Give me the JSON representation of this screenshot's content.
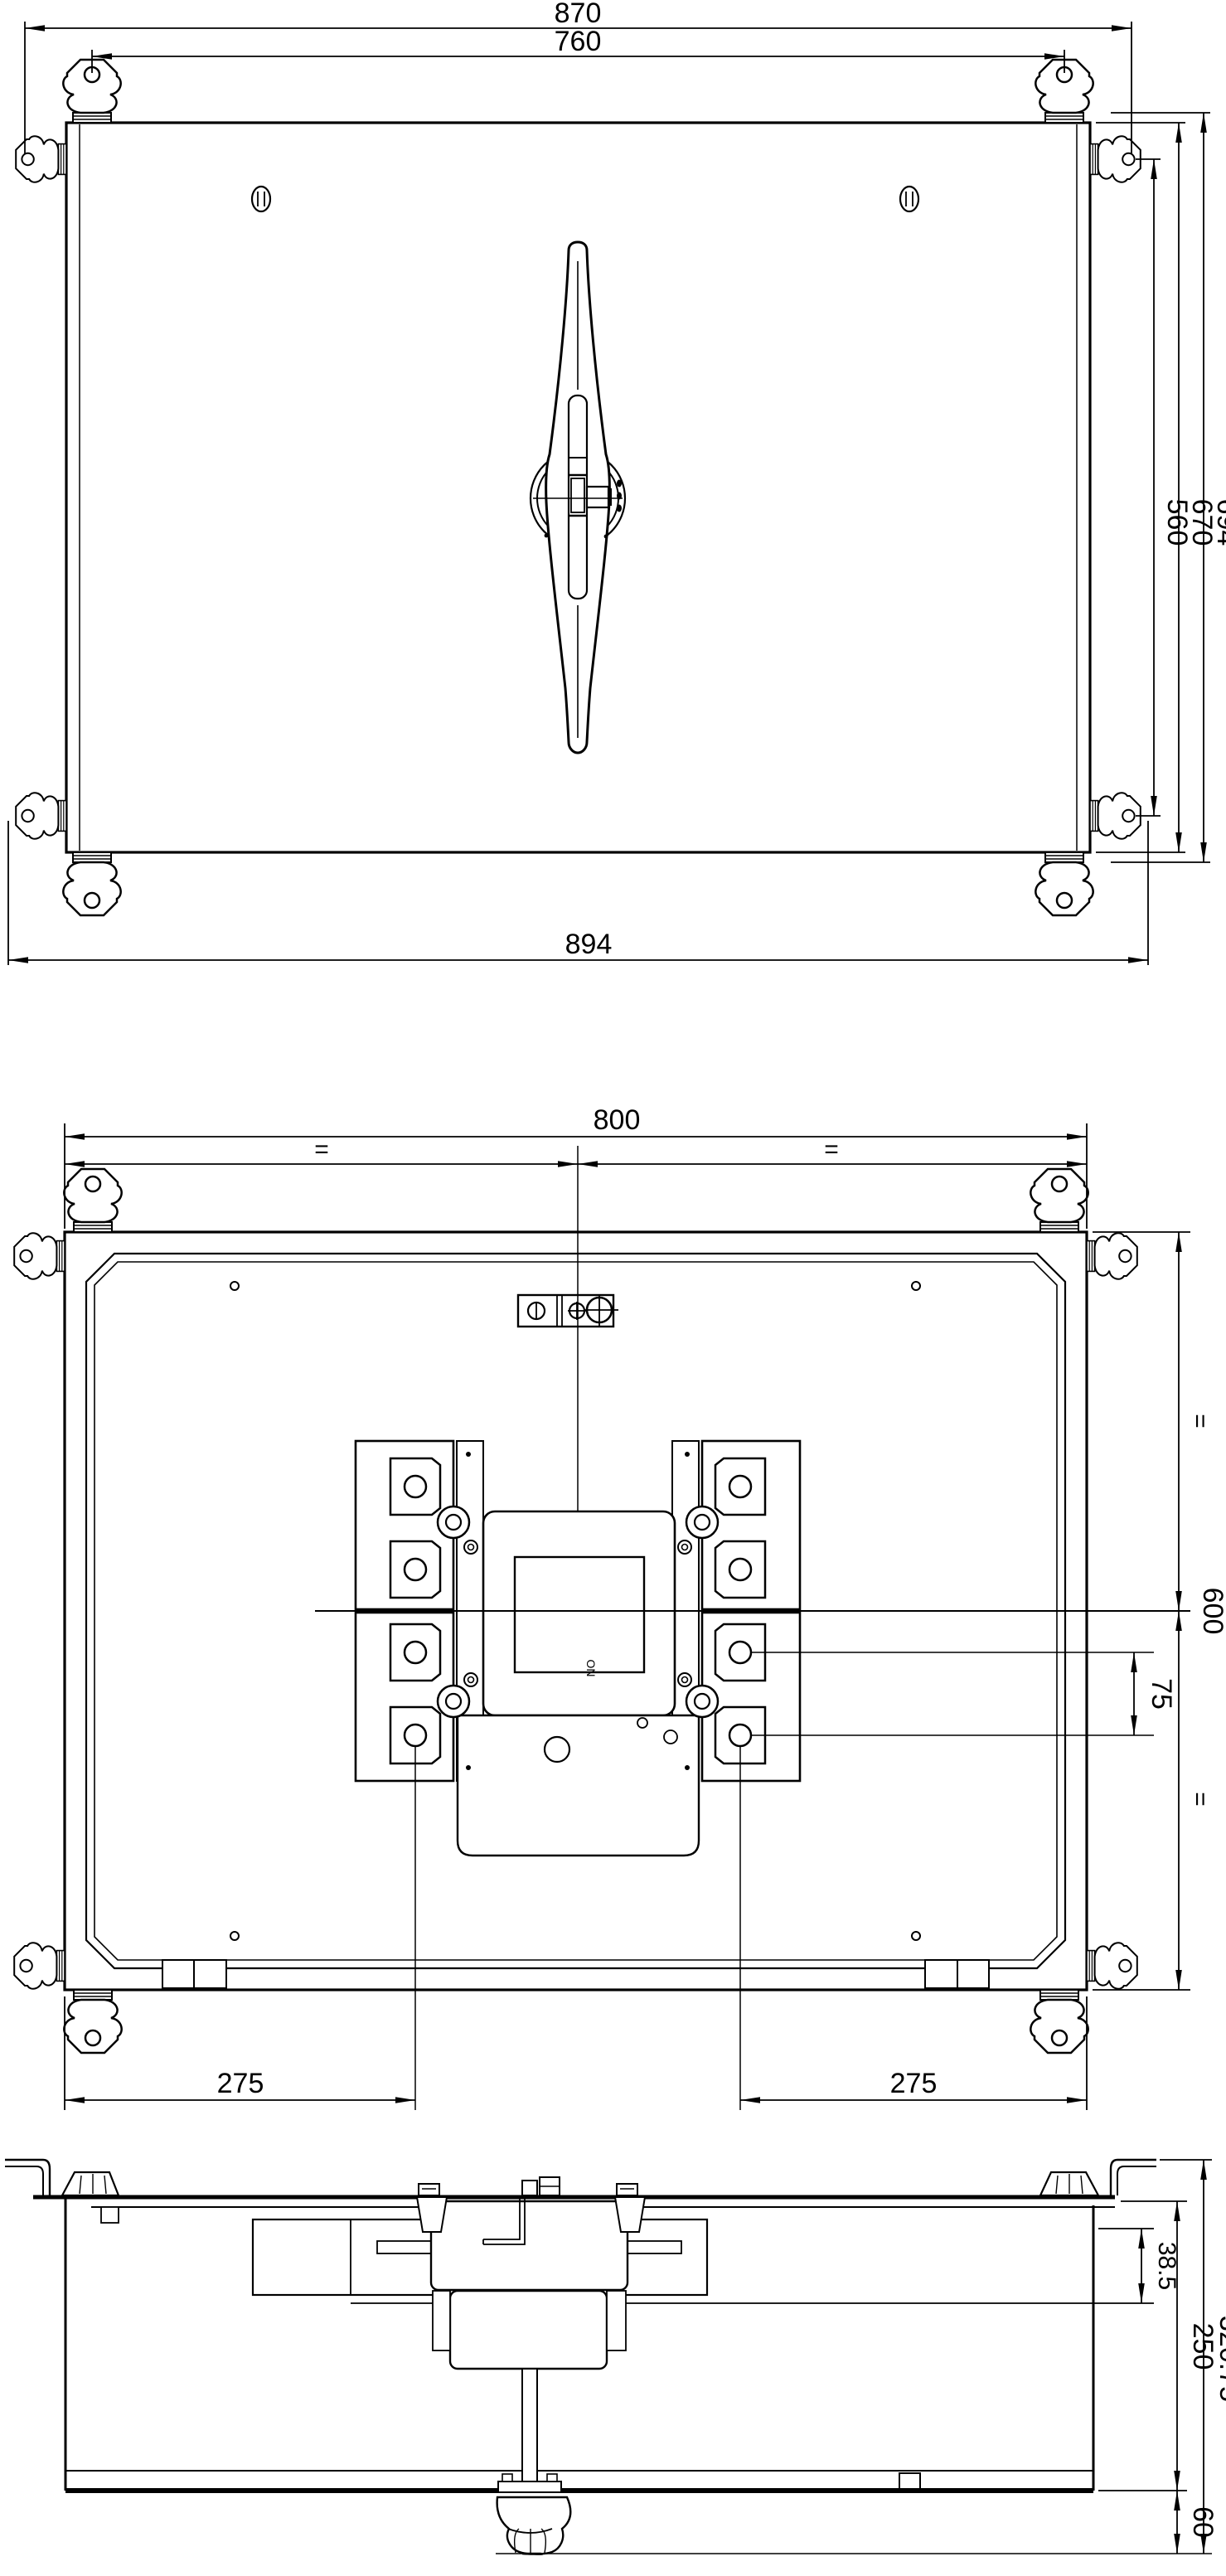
{
  "meta": {
    "background": "#ffffff",
    "line_color": "#000000",
    "drawing_type": "switch-disconnector installation drawing, three orthographic views"
  },
  "front_view": {
    "dims": {
      "overall_width_top": "870",
      "inner_width_top": "760",
      "overall_width_bottom": "894",
      "height_outer": "694",
      "height_mid": "670",
      "height_inner": "560"
    }
  },
  "rear_view": {
    "dims": {
      "width": "800",
      "equal_left": "=",
      "equal_right": "=",
      "height": "600",
      "equal_top": "=",
      "equal_bottom": "=",
      "terminal_pitch": "75",
      "offset_left": "275",
      "offset_right": "275"
    },
    "labels": {
      "orientation": "ON"
    }
  },
  "side_view": {
    "dims": {
      "panel_offset": "38.5",
      "body_depth": "250",
      "overall_depth": "320.75",
      "handle_knob_depth": "60"
    }
  }
}
